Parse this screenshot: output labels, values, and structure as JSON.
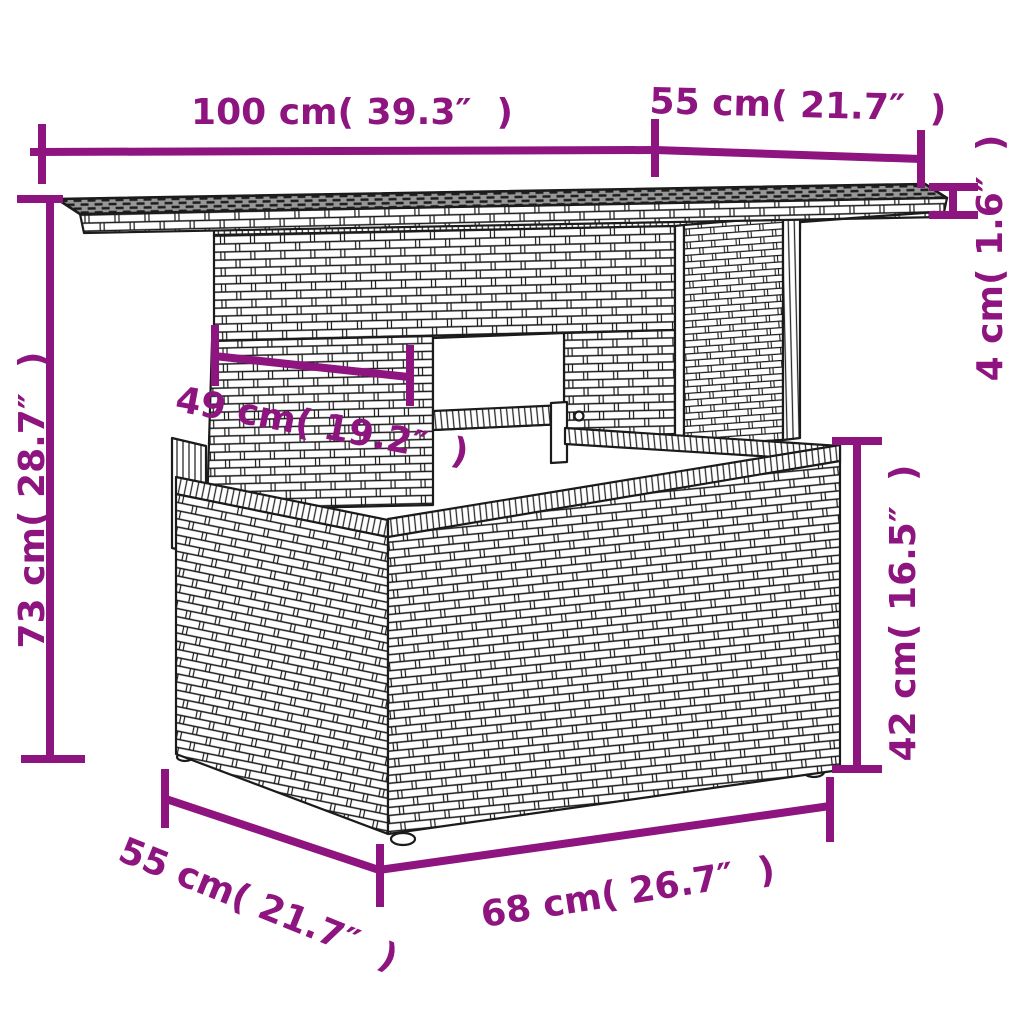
{
  "page": {
    "type": "product-dimension-diagram",
    "subject": "poly rattan lift-top garden table, wicker line drawing",
    "background": "#ffffff"
  },
  "accent_color": "#8E1480",
  "dimensions": [
    {
      "id": "tabletop-width",
      "label": "100 cm( 39.3″  )",
      "cm": "100",
      "inches": "39.3"
    },
    {
      "id": "tabletop-depth",
      "label": "55 cm( 21.7″  )",
      "cm": "55",
      "inches": "21.7"
    },
    {
      "id": "tabletop-thickness",
      "label": "4 cm( 1.6″  )",
      "cm": "4",
      "inches": "1.6"
    },
    {
      "id": "overall-height",
      "label": "73 cm( 28.7″  )",
      "cm": "73",
      "inches": "28.7"
    },
    {
      "id": "side-panel-width",
      "label": "49 cm( 19.2″  )",
      "cm": "49",
      "inches": "19.2"
    },
    {
      "id": "base-height",
      "label": "42 cm( 16.5″  )",
      "cm": "42",
      "inches": "16.5"
    },
    {
      "id": "base-depth",
      "label": "55 cm( 21.7″  )",
      "cm": "55",
      "inches": "21.7"
    },
    {
      "id": "base-width",
      "label": "68 cm( 26.7″  )",
      "cm": "68",
      "inches": "26.7"
    }
  ]
}
